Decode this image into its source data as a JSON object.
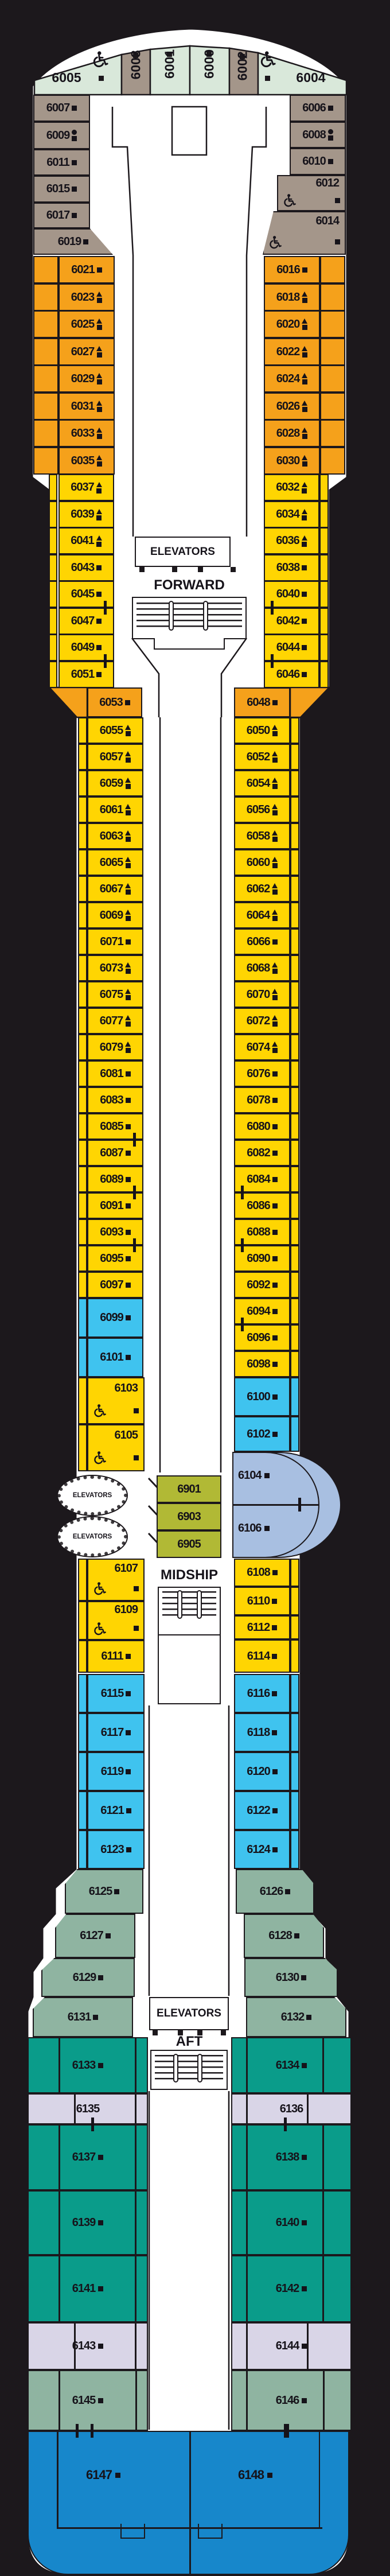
{
  "deck_labels": {
    "forward": "FORWARD",
    "midship": "MIDSHIP",
    "aft": "AFT",
    "elevators": "ELEVATORS"
  },
  "colors": {
    "background": "#1c181c",
    "deck": "#ffffff",
    "mint": "#d9e8da",
    "taupe": "#a4968a",
    "orange": "#f5a11b",
    "yellow": "#ffd502",
    "cyan": "#3fc3ef",
    "olive": "#b1b935",
    "periwinkle": "#a8bfe1",
    "sage": "#8fb4a1",
    "teal": "#0a9c8a",
    "lavender": "#d9d5e7",
    "blue": "#1787cb",
    "line": "#1c181c"
  },
  "icon_legend_names": [
    "square-icon",
    "triangle-square-icon",
    "circle-square-icon",
    "wheelchair-icon",
    "connecting-door-mark"
  ],
  "sections": {
    "bow": {
      "category": "mint_taupe",
      "cabins": [
        {
          "n": "6005",
          "icon": "square",
          "wheelchair": true
        },
        {
          "n": "6003",
          "icon": "square"
        },
        {
          "n": "6001",
          "icon": "square"
        },
        {
          "n": "6000",
          "icon": "square"
        },
        {
          "n": "6002",
          "icon": "square"
        },
        {
          "n": "6004",
          "icon": "square",
          "wheelchair": true
        }
      ]
    },
    "port_brown": {
      "category": "taupe",
      "cabins": [
        {
          "n": "6007",
          "icon": "square"
        },
        {
          "n": "6009",
          "icon": "circle-square"
        },
        {
          "n": "6011",
          "icon": "square"
        },
        {
          "n": "6015",
          "icon": "square"
        },
        {
          "n": "6017",
          "icon": "square"
        },
        {
          "n": "6019",
          "icon": "square"
        }
      ]
    },
    "star_brown": {
      "category": "taupe",
      "cabins": [
        {
          "n": "6006",
          "icon": "square"
        },
        {
          "n": "6008",
          "icon": "circle-square"
        },
        {
          "n": "6010",
          "icon": "square"
        },
        {
          "n": "6012",
          "icon": "square",
          "wheelchair": true
        },
        {
          "n": "6014",
          "icon": "square",
          "wheelchair": true
        }
      ]
    },
    "port_orange": {
      "category": "orange",
      "cabins": [
        {
          "n": "6021",
          "icon": "square"
        },
        {
          "n": "6023",
          "icon": "triangle-square"
        },
        {
          "n": "6025",
          "icon": "triangle-square"
        },
        {
          "n": "6027",
          "icon": "triangle-square"
        },
        {
          "n": "6029",
          "icon": "triangle-square"
        },
        {
          "n": "6031",
          "icon": "triangle-square"
        },
        {
          "n": "6033",
          "icon": "triangle-square"
        },
        {
          "n": "6035",
          "icon": "triangle-square"
        }
      ]
    },
    "star_orange": {
      "category": "orange",
      "cabins": [
        {
          "n": "6016",
          "icon": "square"
        },
        {
          "n": "6018",
          "icon": "triangle-square"
        },
        {
          "n": "6020",
          "icon": "triangle-square"
        },
        {
          "n": "6022",
          "icon": "triangle-square"
        },
        {
          "n": "6024",
          "icon": "triangle-square"
        },
        {
          "n": "6026",
          "icon": "triangle-square"
        },
        {
          "n": "6028",
          "icon": "triangle-square"
        },
        {
          "n": "6030",
          "icon": "triangle-square"
        }
      ]
    },
    "port_yellow_fwd": {
      "category": "yellow",
      "cabins": [
        {
          "n": "6037",
          "icon": "triangle-square"
        },
        {
          "n": "6039",
          "icon": "triangle-square"
        },
        {
          "n": "6041",
          "icon": "triangle-square"
        },
        {
          "n": "6043",
          "icon": "square"
        },
        {
          "n": "6045",
          "icon": "square",
          "connector": true
        },
        {
          "n": "6047",
          "icon": "square"
        },
        {
          "n": "6049",
          "icon": "square",
          "connector": true
        },
        {
          "n": "6051",
          "icon": "square"
        }
      ]
    },
    "star_yellow_fwd": {
      "category": "yellow",
      "cabins": [
        {
          "n": "6032",
          "icon": "triangle-square"
        },
        {
          "n": "6034",
          "icon": "triangle-square"
        },
        {
          "n": "6036",
          "icon": "triangle-square"
        },
        {
          "n": "6038",
          "icon": "square"
        },
        {
          "n": "6040",
          "icon": "square",
          "connector": true
        },
        {
          "n": "6042",
          "icon": "square"
        },
        {
          "n": "6044",
          "icon": "square",
          "connector": true
        },
        {
          "n": "6046",
          "icon": "square"
        }
      ]
    },
    "port_orange_single": {
      "category": "orange",
      "cabins": [
        {
          "n": "6053",
          "icon": "square"
        }
      ]
    },
    "star_orange_single": {
      "category": "orange",
      "cabins": [
        {
          "n": "6048",
          "icon": "square"
        }
      ]
    },
    "port_yellow_mid": {
      "category": "yellow",
      "cabins": [
        {
          "n": "6055",
          "icon": "triangle-square"
        },
        {
          "n": "6057",
          "icon": "triangle-square"
        },
        {
          "n": "6059",
          "icon": "triangle-square"
        },
        {
          "n": "6061",
          "icon": "triangle-square"
        },
        {
          "n": "6063",
          "icon": "triangle-square"
        },
        {
          "n": "6065",
          "icon": "triangle-square"
        },
        {
          "n": "6067",
          "icon": "triangle-square"
        },
        {
          "n": "6069",
          "icon": "triangle-square"
        },
        {
          "n": "6071",
          "icon": "square"
        },
        {
          "n": "6073",
          "icon": "triangle-square"
        },
        {
          "n": "6075",
          "icon": "triangle-square"
        },
        {
          "n": "6077",
          "icon": "triangle-square"
        },
        {
          "n": "6079",
          "icon": "triangle-square"
        },
        {
          "n": "6081",
          "icon": "square"
        },
        {
          "n": "6083",
          "icon": "square"
        },
        {
          "n": "6085",
          "icon": "square",
          "connector": true
        },
        {
          "n": "6087",
          "icon": "square"
        },
        {
          "n": "6089",
          "icon": "square",
          "connector": true
        },
        {
          "n": "6091",
          "icon": "square"
        },
        {
          "n": "6093",
          "icon": "square",
          "connector": true
        },
        {
          "n": "6095",
          "icon": "square"
        },
        {
          "n": "6097",
          "icon": "square"
        }
      ]
    },
    "star_yellow_mid": {
      "category": "yellow",
      "cabins": [
        {
          "n": "6050",
          "icon": "triangle-square"
        },
        {
          "n": "6052",
          "icon": "triangle-square"
        },
        {
          "n": "6054",
          "icon": "triangle-square"
        },
        {
          "n": "6056",
          "icon": "triangle-square"
        },
        {
          "n": "6058",
          "icon": "triangle-square"
        },
        {
          "n": "6060",
          "icon": "triangle-square"
        },
        {
          "n": "6062",
          "icon": "triangle-square"
        },
        {
          "n": "6064",
          "icon": "triangle-square"
        },
        {
          "n": "6066",
          "icon": "square"
        },
        {
          "n": "6068",
          "icon": "triangle-square"
        },
        {
          "n": "6070",
          "icon": "triangle-square"
        },
        {
          "n": "6072",
          "icon": "triangle-square"
        },
        {
          "n": "6074",
          "icon": "triangle-square"
        },
        {
          "n": "6076",
          "icon": "square"
        },
        {
          "n": "6078",
          "icon": "square"
        },
        {
          "n": "6080",
          "icon": "square"
        },
        {
          "n": "6082",
          "icon": "square"
        },
        {
          "n": "6084",
          "icon": "square",
          "connector": true
        },
        {
          "n": "6086",
          "icon": "square"
        },
        {
          "n": "6088",
          "icon": "square",
          "connector": true
        },
        {
          "n": "6090",
          "icon": "square"
        },
        {
          "n": "6092",
          "icon": "square"
        },
        {
          "n": "6094",
          "icon": "square",
          "connector": true
        },
        {
          "n": "6096",
          "icon": "square"
        },
        {
          "n": "6098",
          "icon": "square"
        }
      ]
    },
    "port_cyan_pre": {
      "category": "cyan",
      "cabins": [
        {
          "n": "6099",
          "icon": "square"
        },
        {
          "n": "6101",
          "icon": "square"
        }
      ]
    },
    "star_cyan_pre": {
      "category": "cyan",
      "cabins": [
        {
          "n": "6100",
          "icon": "square"
        },
        {
          "n": "6102",
          "icon": "square"
        }
      ]
    },
    "port_yellow_wc": {
      "category": "yellow",
      "cabins": [
        {
          "n": "6103",
          "icon": "square",
          "wheelchair": true
        },
        {
          "n": "6105",
          "icon": "square",
          "wheelchair": true
        }
      ]
    },
    "center_olive": {
      "category": "olive",
      "cabins": [
        {
          "n": "6901"
        },
        {
          "n": "6903"
        },
        {
          "n": "6905"
        }
      ]
    },
    "star_periwinkle": {
      "category": "periwinkle",
      "cabins": [
        {
          "n": "6104",
          "icon": "square",
          "connector": true
        },
        {
          "n": "6106",
          "icon": "square"
        }
      ]
    },
    "port_after_mid": {
      "category": "yellow",
      "cabins": [
        {
          "n": "6107",
          "icon": "square",
          "wheelchair": true
        },
        {
          "n": "6109",
          "icon": "square",
          "wheelchair": true
        },
        {
          "n": "6111",
          "icon": "square"
        }
      ]
    },
    "star_after_mid": {
      "category": "yellow",
      "cabins": [
        {
          "n": "6108",
          "icon": "square"
        },
        {
          "n": "6110",
          "icon": "square"
        },
        {
          "n": "6112",
          "icon": "square"
        },
        {
          "n": "6114",
          "icon": "square"
        }
      ]
    },
    "port_cyan_aft": {
      "category": "cyan",
      "cabins": [
        {
          "n": "6115",
          "icon": "square"
        },
        {
          "n": "6117",
          "icon": "square"
        },
        {
          "n": "6119",
          "icon": "square"
        },
        {
          "n": "6121",
          "icon": "square"
        },
        {
          "n": "6123",
          "icon": "square"
        }
      ]
    },
    "star_cyan_aft": {
      "category": "cyan",
      "cabins": [
        {
          "n": "6116",
          "icon": "square"
        },
        {
          "n": "6118",
          "icon": "square"
        },
        {
          "n": "6120",
          "icon": "square"
        },
        {
          "n": "6122",
          "icon": "square"
        },
        {
          "n": "6124",
          "icon": "square"
        }
      ]
    },
    "port_sage": {
      "category": "sage",
      "cabins": [
        {
          "n": "6125",
          "icon": "square"
        },
        {
          "n": "6127",
          "icon": "square"
        },
        {
          "n": "6129",
          "icon": "square"
        },
        {
          "n": "6131",
          "icon": "square"
        }
      ]
    },
    "star_sage": {
      "category": "sage",
      "cabins": [
        {
          "n": "6126",
          "icon": "square"
        },
        {
          "n": "6128",
          "icon": "square"
        },
        {
          "n": "6130",
          "icon": "square"
        },
        {
          "n": "6132",
          "icon": "square"
        }
      ]
    },
    "port_teal": {
      "category": "teal",
      "cabins": [
        {
          "n": "6133",
          "icon": "square"
        },
        {
          "n": "6137",
          "icon": "square"
        },
        {
          "n": "6139",
          "icon": "square"
        },
        {
          "n": "6141",
          "icon": "square"
        }
      ]
    },
    "star_teal": {
      "category": "teal",
      "cabins": [
        {
          "n": "6134",
          "icon": "square"
        },
        {
          "n": "6138",
          "icon": "square"
        },
        {
          "n": "6140",
          "icon": "square"
        },
        {
          "n": "6142",
          "icon": "square"
        }
      ]
    },
    "port_lavender": {
      "category": "lavender",
      "cabins": [
        {
          "n": "6135",
          "connector": true
        },
        {
          "n": "6143",
          "icon": "square"
        }
      ]
    },
    "star_lavender": {
      "category": "lavender",
      "cabins": [
        {
          "n": "6136",
          "connector": true
        },
        {
          "n": "6144",
          "icon": "square"
        }
      ]
    },
    "port_sage_stern": {
      "category": "sage",
      "cabins": [
        {
          "n": "6145",
          "icon": "square",
          "connector": true
        }
      ]
    },
    "star_sage_stern": {
      "category": "sage",
      "cabins": [
        {
          "n": "6146",
          "icon": "square",
          "connector": true
        }
      ]
    },
    "stern_suites": {
      "category": "blue",
      "cabins": [
        {
          "n": "6147",
          "icon": "square"
        },
        {
          "n": "6148",
          "icon": "square"
        }
      ]
    }
  }
}
